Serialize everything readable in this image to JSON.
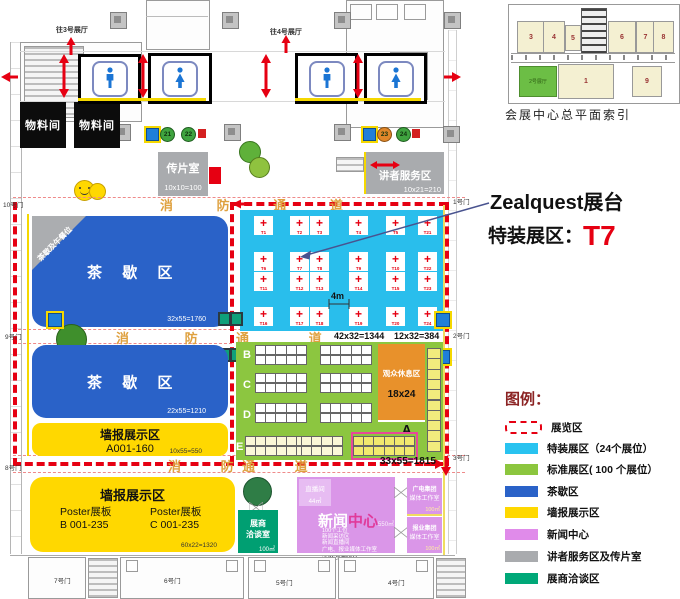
{
  "annotation": {
    "booth_owner": "Zealquest展台",
    "zone_label": "特装展区：",
    "booth_id": "T7"
  },
  "index_map": {
    "caption": "会展中心总平面索引",
    "top_blocks": [
      "3",
      "4",
      "5",
      "6",
      "7",
      "8"
    ],
    "green_block": "2号展厅",
    "bottom_blocks": [
      "1",
      "9"
    ]
  },
  "legend": {
    "title": "图例：",
    "items": [
      {
        "label": "展览区",
        "swatch": "dashed",
        "color": "#e60012"
      },
      {
        "label": "特装展区（24个展位）",
        "swatch": "fill",
        "color": "#29c3f0"
      },
      {
        "label": "标准展区( 100 个展位）",
        "swatch": "fill",
        "color": "#8cc63e"
      },
      {
        "label": "茶歇区",
        "swatch": "fill",
        "color": "#2a62c8"
      },
      {
        "label": "墙报展示区",
        "swatch": "fill",
        "color": "#ffd800"
      },
      {
        "label": "新闻中心",
        "swatch": "fill",
        "color": "#e08bea"
      },
      {
        "label": "讲者服务区及传片室",
        "swatch": "fill",
        "color": "#a9abae"
      },
      {
        "label": "展商洽谈区",
        "swatch": "fill",
        "color": "#00a878"
      }
    ]
  },
  "plan": {
    "to_hall_left": "往3号展厅",
    "to_hall_right": "往4号展厅",
    "material_room_1": "物料间",
    "material_room_2": "物料间",
    "markers": [
      "21",
      "22",
      "23",
      "24"
    ],
    "media_room": {
      "name": "传片室",
      "dim": "10x10=100"
    },
    "speaker_service": {
      "name": "讲者服务区",
      "dim": "10x21=210"
    },
    "fire_lanes": {
      "lane1": "消 防 通 道",
      "lane2_left": "消 防",
      "lane2_right": "通 道",
      "lane3_left": "消 防",
      "lane3_right": "通 道"
    },
    "tea_area_1": {
      "name": "茶 歇 区",
      "corner_note": "茶歇及午餐位",
      "dim": "32x55=1760"
    },
    "tea_area_2": {
      "name": "茶 歇 区",
      "dim": "22x55=1210"
    },
    "poster_area_a": {
      "title": "墙报展示区",
      "range": "A001-160",
      "dim": "10x55=550"
    },
    "special_zone": {
      "booths": [
        "T1",
        "T2",
        "T3",
        "T4",
        "T5",
        "T6",
        "T7",
        "T8",
        "T9",
        "T10",
        "T11",
        "T12",
        "T13",
        "T14",
        "T15",
        "T16",
        "T17",
        "T18",
        "T19",
        "T20",
        "T21",
        "T22",
        "T23",
        "T24"
      ],
      "aisle_dim": "4m",
      "dim_main": "42x32=1344",
      "dim_side": "12x32=384"
    },
    "standard_zone": {
      "row_labels": [
        "B",
        "C",
        "D",
        "E"
      ],
      "zone_label_a": "A",
      "rest_area": {
        "name": "观众休息区",
        "dim": "18x24"
      },
      "dim": "33x55=1815"
    },
    "poster_area_bc": {
      "title": "墙报展示区",
      "left_title": "Poster展板",
      "left_range": "B 001-235",
      "right_title": "Poster展板",
      "right_range": "C 001-235",
      "dim": "60x22=1320"
    },
    "negotiation_room": {
      "line1": "展商",
      "line2": "洽谈室",
      "area": "100㎡"
    },
    "news_center": {
      "studio": "直播间",
      "studio_area": "44㎡",
      "title_1": "新闻",
      "title_2": "中心",
      "area": "550㎡",
      "details": [
        "100个工位",
        "新闻采访区",
        "新闻直播间",
        "广电、报业媒体工作室"
      ],
      "dim": "22x25=550"
    },
    "media_office_1": {
      "line1": "广电集团",
      "line2": "媒体工作室",
      "area": "100㎡"
    },
    "media_office_2": {
      "line1": "报业集团",
      "line2": "媒体工作室",
      "area": "100㎡"
    },
    "gates": {
      "left": [
        "10号门",
        "9号门",
        "8号门"
      ],
      "bottom": [
        "7号门",
        "6号门",
        "5号门",
        "4号门"
      ],
      "right": [
        "1号门",
        "2号门",
        "3号门"
      ]
    }
  }
}
